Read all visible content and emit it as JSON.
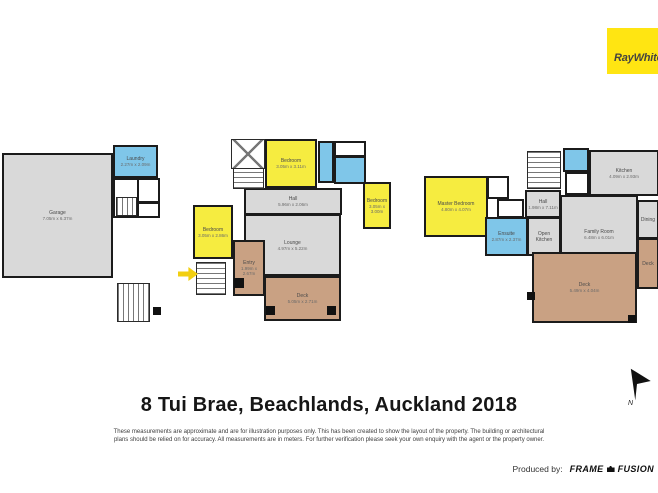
{
  "brand": {
    "logo_text": "RayWhite.",
    "bg": "#ffe512",
    "fg": "#45443f"
  },
  "title": "8 Tui Brae, Beachlands, Auckland 2018",
  "disclaimer_line1": "These measurements are approximate and are for illustration purposes only. This has been created to show the layout of the property. The building or architectural",
  "disclaimer_line2": "plans should be relied on for accuracy. All measurements are in meters. For further verification please seek your own enquiry with the agent or the property owner.",
  "footer": {
    "produced_by": "Produced by:",
    "producer_word1": "FRAME",
    "producer_word2": "FUSION"
  },
  "compass": {
    "label": "N"
  },
  "palette": {
    "wall": "#1b1b1b",
    "gray": "#d9d9d9",
    "yellow": "#f6ec40",
    "blue": "#7fc6e9",
    "tan": "#c9a183",
    "white": "#ffffff",
    "arrow": "#f2cf10"
  },
  "floorplans": [
    {
      "name": "garage-level",
      "rooms": [
        {
          "label": "Garage",
          "dims": "7.05m x 6.37m",
          "x": 2,
          "y": 153,
          "w": 111,
          "h": 125,
          "fill": "gray"
        },
        {
          "label": "Laundry",
          "dims": "2.27m x 2.09m",
          "x": 113,
          "y": 145,
          "w": 45,
          "h": 33,
          "fill": "blue"
        },
        {
          "label": "",
          "dims": "",
          "x": 113,
          "y": 178,
          "w": 26,
          "h": 40,
          "fill": "white"
        },
        {
          "label": "",
          "dims": "",
          "x": 137,
          "y": 178,
          "w": 23,
          "h": 25,
          "fill": "white"
        },
        {
          "label": "",
          "dims": "",
          "x": 137,
          "y": 202,
          "w": 23,
          "h": 16,
          "fill": "white"
        }
      ],
      "stairs": [
        {
          "x": 116,
          "y": 197,
          "w": 21,
          "h": 19,
          "dir": "v"
        },
        {
          "x": 117,
          "y": 283,
          "w": 33,
          "h": 39,
          "dir": "v"
        }
      ],
      "posts": [
        {
          "x": 153,
          "y": 307,
          "s": 8
        }
      ]
    },
    {
      "name": "main-level",
      "rooms": [
        {
          "label": "Bedroom",
          "dims": "3.05m x 3.11m",
          "x": 265,
          "y": 139,
          "w": 52,
          "h": 49,
          "fill": "yellow"
        },
        {
          "label": "",
          "dims": "",
          "x": 318,
          "y": 141,
          "w": 16,
          "h": 42,
          "fill": "blue"
        },
        {
          "label": "",
          "dims": "",
          "x": 334,
          "y": 141,
          "w": 32,
          "h": 16,
          "fill": "white"
        },
        {
          "label": "",
          "dims": "",
          "x": 334,
          "y": 156,
          "w": 32,
          "h": 28,
          "fill": "blue"
        },
        {
          "label": "Hall",
          "dims": "5.96m x 2.06m",
          "x": 244,
          "y": 188,
          "w": 98,
          "h": 27,
          "fill": "gray"
        },
        {
          "label": "Bedroom",
          "dims": "3.05m x 3.00m",
          "x": 363,
          "y": 182,
          "w": 28,
          "h": 47,
          "fill": "yellow"
        },
        {
          "label": "Bedroom",
          "dims": "3.05m x 2.86m",
          "x": 193,
          "y": 205,
          "w": 40,
          "h": 54,
          "fill": "yellow"
        },
        {
          "label": "Lounge",
          "dims": "4.97m x 5.22m",
          "x": 244,
          "y": 214,
          "w": 97,
          "h": 62,
          "fill": "gray"
        },
        {
          "label": "Entry",
          "dims": "1.99m x 2.67m",
          "x": 233,
          "y": 240,
          "w": 32,
          "h": 56,
          "fill": "tan"
        },
        {
          "label": "Deck",
          "dims": "5.05m x 2.71m",
          "x": 264,
          "y": 276,
          "w": 77,
          "h": 45,
          "fill": "tan"
        }
      ],
      "stairs": [
        {
          "x": 231,
          "y": 139,
          "w": 34,
          "h": 30,
          "dir": "x"
        },
        {
          "x": 233,
          "y": 168,
          "w": 31,
          "h": 21,
          "dir": "h"
        },
        {
          "x": 196,
          "y": 262,
          "w": 30,
          "h": 33,
          "dir": "h"
        }
      ],
      "posts": [
        {
          "x": 234,
          "y": 278,
          "s": 10
        },
        {
          "x": 266,
          "y": 306,
          "s": 9
        },
        {
          "x": 327,
          "y": 306,
          "s": 9
        }
      ],
      "arrow": {
        "x": 178,
        "y": 267
      }
    },
    {
      "name": "upper-level",
      "rooms": [
        {
          "label": "Master Bedroom",
          "dims": "4.80m x 4.07m",
          "x": 424,
          "y": 176,
          "w": 64,
          "h": 61,
          "fill": "yellow"
        },
        {
          "label": "",
          "dims": "",
          "x": 487,
          "y": 176,
          "w": 22,
          "h": 23,
          "fill": "white"
        },
        {
          "label": "",
          "dims": "",
          "x": 497,
          "y": 199,
          "w": 27,
          "h": 19,
          "fill": "white"
        },
        {
          "label": "Ensuite",
          "dims": "2.87m x 2.37m",
          "x": 485,
          "y": 217,
          "w": 43,
          "h": 39,
          "fill": "blue"
        },
        {
          "label": "Hall",
          "dims": "1.98m x 7.11m",
          "x": 525,
          "y": 190,
          "w": 36,
          "h": 28,
          "fill": "gray"
        },
        {
          "label": "",
          "dims": "",
          "x": 563,
          "y": 148,
          "w": 26,
          "h": 24,
          "fill": "blue"
        },
        {
          "label": "",
          "dims": "",
          "x": 565,
          "y": 172,
          "w": 24,
          "h": 23,
          "fill": "white"
        },
        {
          "label": "Kitchen",
          "dims": "4.09m x 2.93m",
          "x": 589,
          "y": 150,
          "w": 70,
          "h": 46,
          "fill": "gray"
        },
        {
          "label": "Family Room",
          "dims": "6.48m x 6.01m",
          "x": 560,
          "y": 195,
          "w": 78,
          "h": 78,
          "fill": "gray"
        },
        {
          "label": "Open Kitchen",
          "dims": "",
          "x": 527,
          "y": 217,
          "w": 34,
          "h": 39,
          "fill": "gray"
        },
        {
          "label": "Dining",
          "dims": "",
          "x": 637,
          "y": 200,
          "w": 22,
          "h": 39,
          "fill": "gray"
        },
        {
          "label": "Deck",
          "dims": "5.49m x 4.04m",
          "x": 532,
          "y": 252,
          "w": 105,
          "h": 71,
          "fill": "tan"
        },
        {
          "label": "Deck",
          "dims": "",
          "x": 637,
          "y": 238,
          "w": 22,
          "h": 51,
          "fill": "tan"
        }
      ],
      "stairs": [
        {
          "x": 527,
          "y": 151,
          "w": 34,
          "h": 38,
          "dir": "h"
        }
      ],
      "posts": [
        {
          "x": 527,
          "y": 292,
          "s": 8
        },
        {
          "x": 628,
          "y": 315,
          "s": 8
        }
      ]
    }
  ]
}
